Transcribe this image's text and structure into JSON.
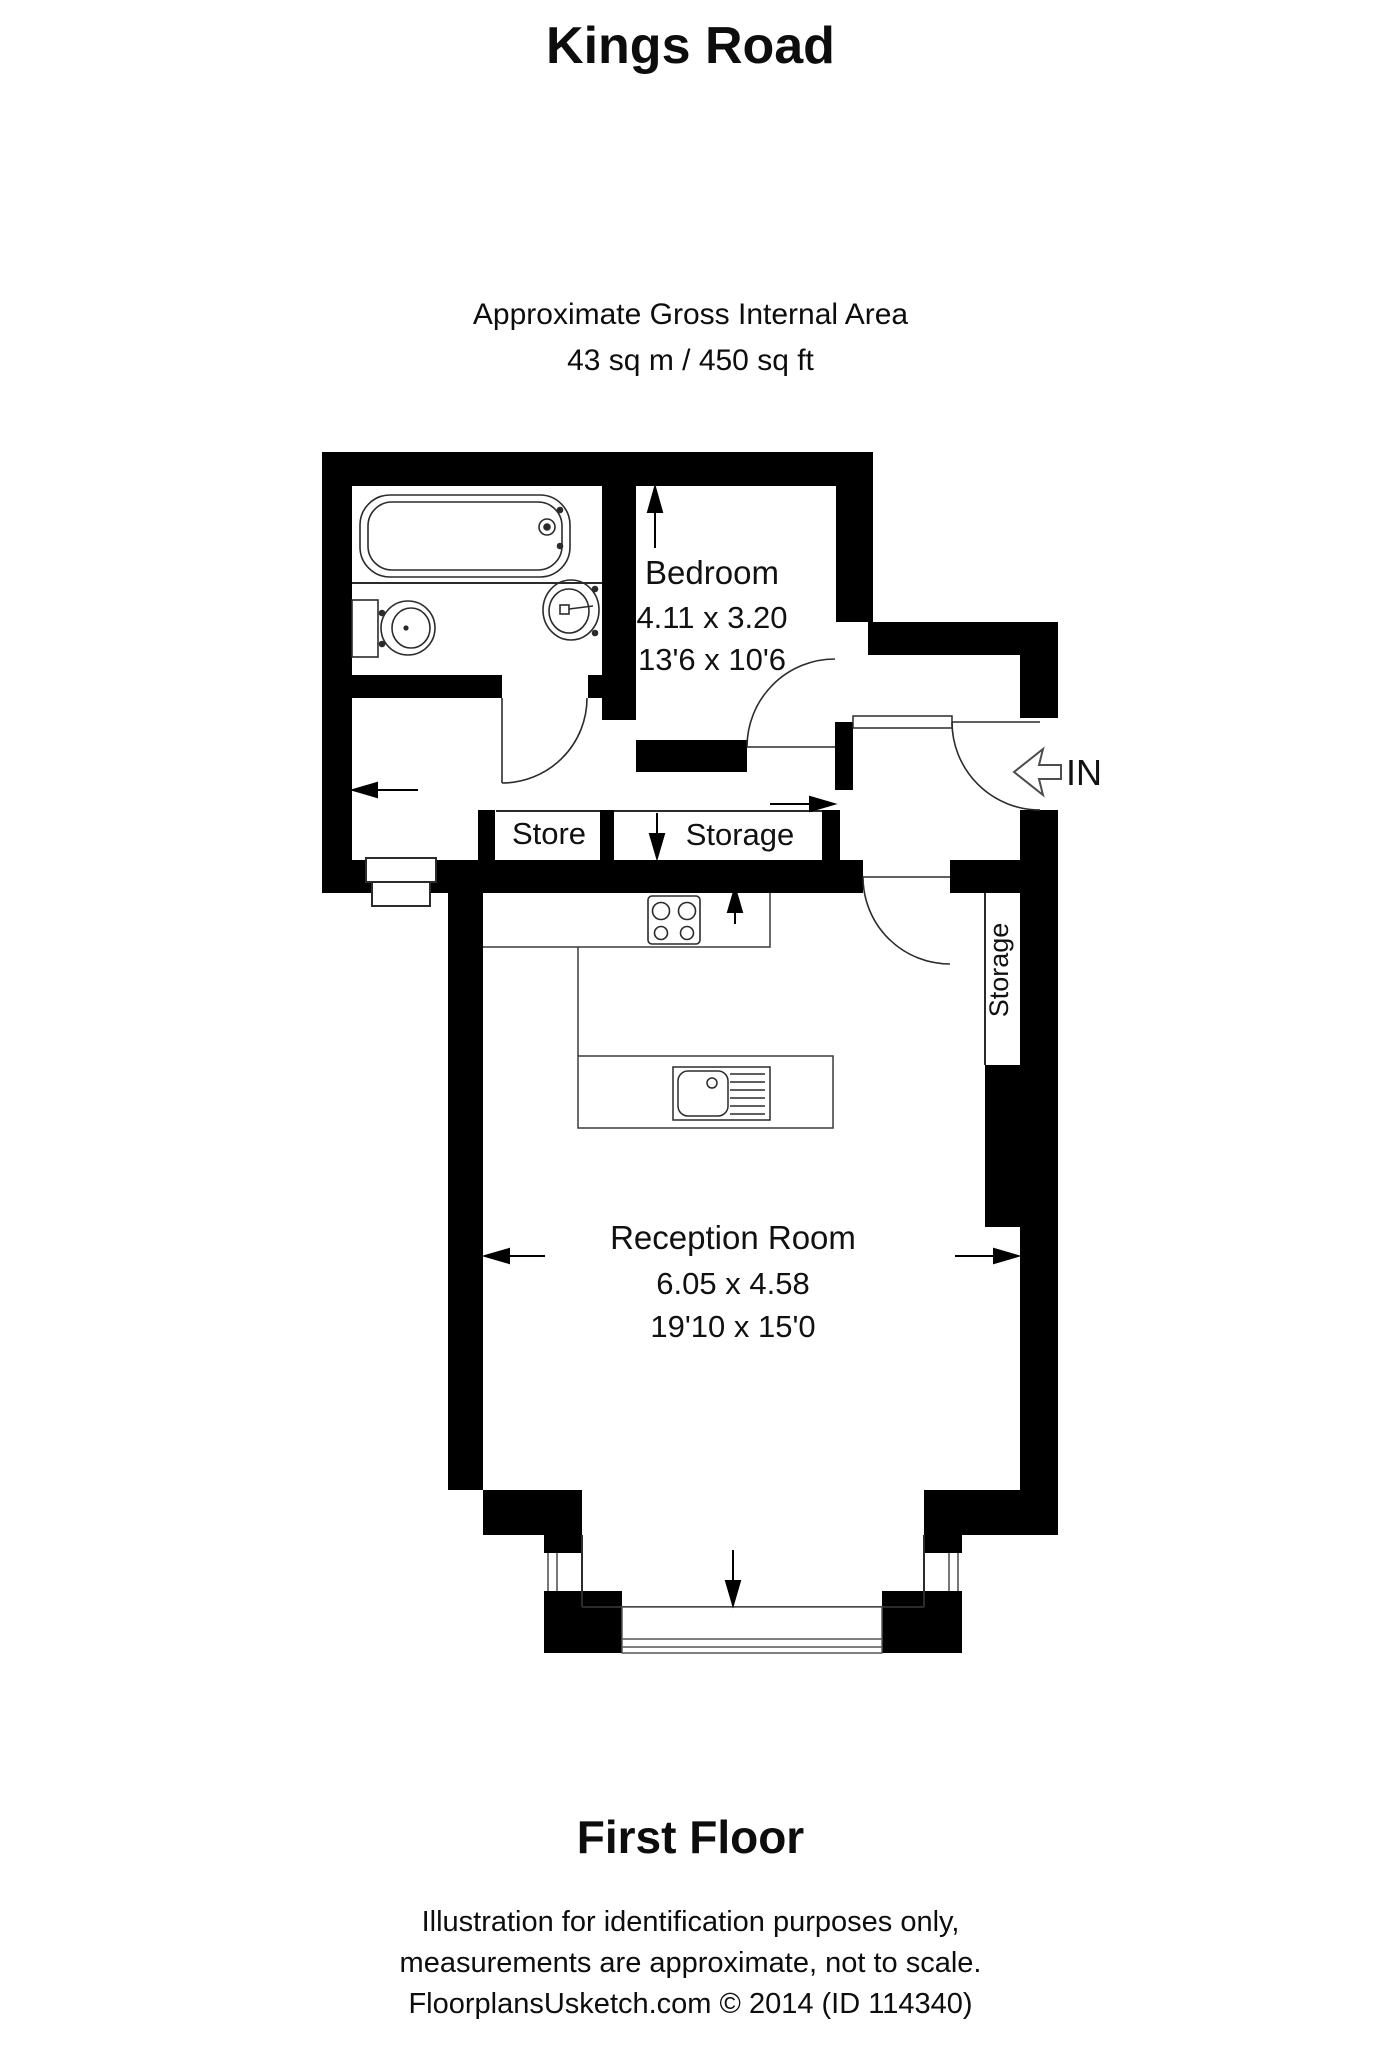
{
  "title": "Kings Road",
  "area_note": {
    "line1": "Approximate Gross Internal Area",
    "line2": "43 sq m / 450 sq ft"
  },
  "rooms": {
    "bedroom": {
      "name": "Bedroom",
      "metric": "4.11 x 3.20",
      "imperial": "13'6 x 10'6"
    },
    "reception": {
      "name": "Reception Room",
      "metric": "6.05 x 4.58",
      "imperial": "19'10 x 15'0"
    },
    "store": {
      "name": "Store"
    },
    "storage": {
      "name": "Storage"
    },
    "storage_vertical": {
      "name": "Storage"
    }
  },
  "entrance": {
    "label": "IN"
  },
  "floor_label": "First Floor",
  "footer": {
    "line1": "Illustration for identification purposes only,",
    "line2": "measurements are approximate, not to scale.",
    "line3": "FloorplansUsketch.com © 2014 (ID 114340)"
  },
  "colors": {
    "wall": "#000000",
    "background": "#ffffff",
    "line": "#2b2b2b"
  }
}
